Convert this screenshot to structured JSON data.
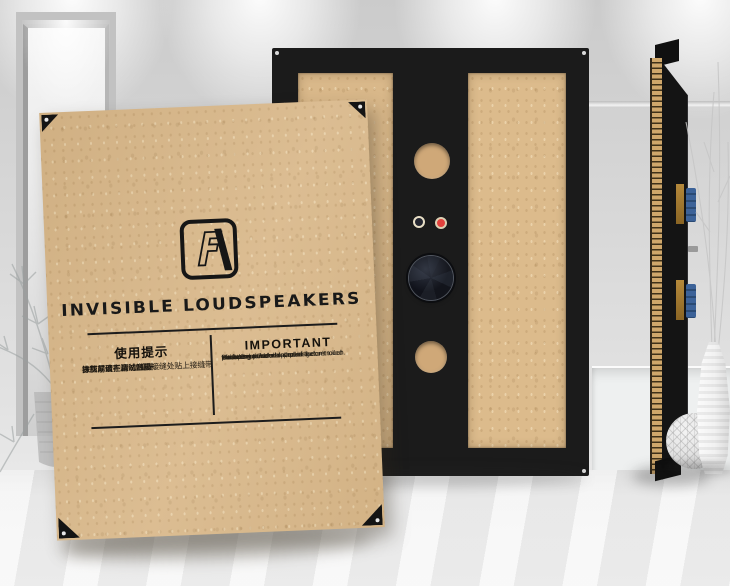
{
  "poster": {
    "logo_monogram": "FA",
    "title": "INVISIBLE LOUDSPEAKERS",
    "usage": {
      "heading": "使用提示",
      "lines": [
        "抹灰前请先测试音箱",
        "表面易破，请勿触碰",
        "抹灰前请在音响四周接缝处贴上接缝带",
        "涂抹厚度不超过2毫米"
      ]
    },
    "important": {
      "heading": "IMPORTANT",
      "lines": [
        "Please test the loudspeaker before",
        "plastering powder.",
        "Surface is vulnerable , please don't touch.",
        "Seal the seams all round of the",
        "loudspeaker before plastering.",
        "Plastering thickness should be controlled",
        "within 2mm."
      ]
    }
  },
  "colors": {
    "kraft_paper": "#d9b88a",
    "frame_black": "#1b1b1b",
    "indicator_red": "#e2413c",
    "indicator_ring": "#e8dfc6",
    "wall_gray": "#d6d6d6",
    "floor_gray": "#f2f2f2",
    "edge_gold": "#cfa76b"
  }
}
